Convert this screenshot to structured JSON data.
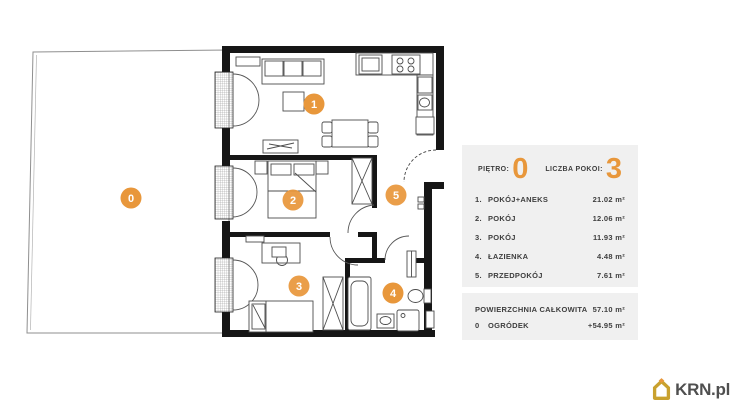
{
  "plan": {
    "area_labels": [
      "0",
      "1",
      "2",
      "3",
      "4",
      "5"
    ]
  },
  "panel": {
    "floor_label": "PIĘTRO:",
    "floor_value": "0",
    "rooms_count_label": "LICZBA POKOI:",
    "rooms_count_value": "3",
    "rooms": [
      {
        "no": "1.",
        "name": "POKÓJ+ANEKS",
        "area": "21.02 m²"
      },
      {
        "no": "2.",
        "name": "POKÓJ",
        "area": "12.06 m²"
      },
      {
        "no": "3.",
        "name": "POKÓJ",
        "area": "11.93 m²"
      },
      {
        "no": "4.",
        "name": "ŁAZIENKA",
        "area": "4.48 m²"
      },
      {
        "no": "5.",
        "name": "PRZEDPOKÓJ",
        "area": "7.61 m²"
      }
    ],
    "summary": [
      {
        "no": "",
        "name": "POWIERZCHNIA CAŁKOWITA",
        "area": "57.10 m²"
      },
      {
        "no": "0",
        "name": "OGRÓDEK",
        "area": "+54.95 m²"
      }
    ]
  },
  "logo": {
    "text": "KRN.pl"
  },
  "colors": {
    "accent_orange": "#E8973B",
    "panel_bg": "#F0F0F0",
    "text_dark": "#3E3E3E",
    "wall_black": "#161616",
    "logo_gold": "#C9A12E"
  }
}
